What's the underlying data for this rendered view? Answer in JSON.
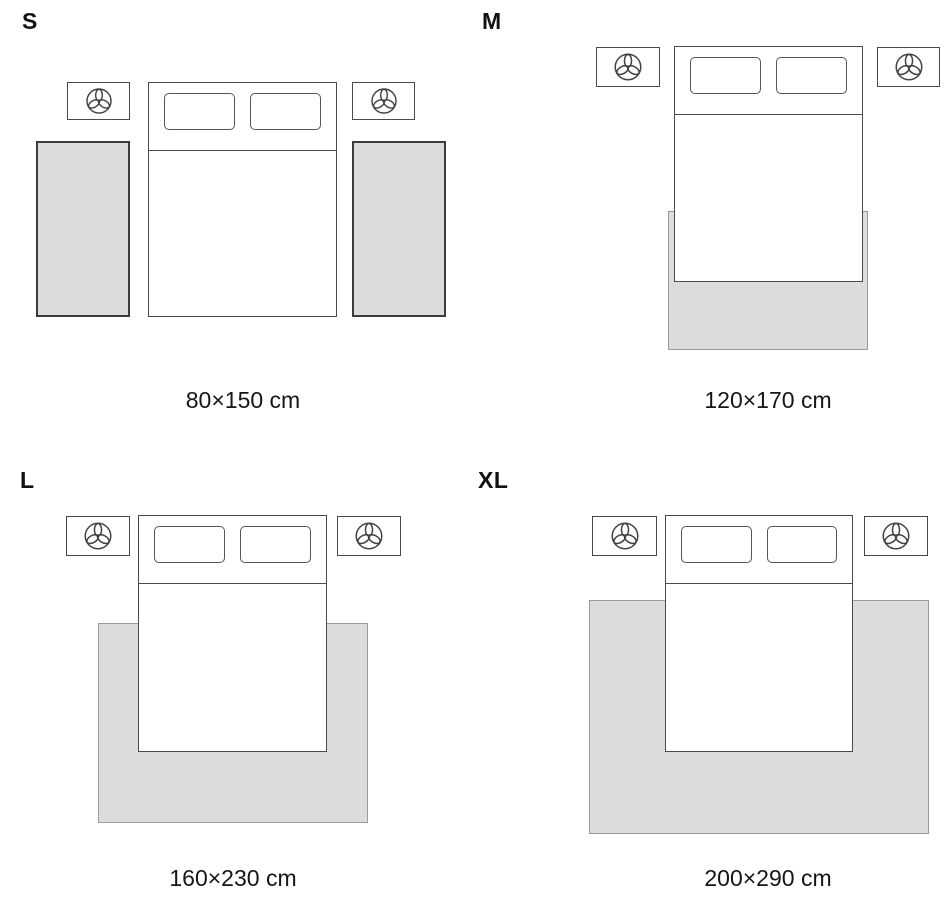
{
  "colors": {
    "background": "#ffffff",
    "rug_fill": "#dcdcdc",
    "rug_border": "#9b9b9b",
    "runner_rug_border": "#3c3c3c",
    "furniture_outline": "#4a4a4a",
    "text": "#111111"
  },
  "icons": {
    "nightstand": "three-petal-plant-icon"
  },
  "panels": [
    {
      "size_label": "S",
      "dimensions": "80×150 cm"
    },
    {
      "size_label": "M",
      "dimensions": "120×170 cm"
    },
    {
      "size_label": "L",
      "dimensions": "160×230 cm"
    },
    {
      "size_label": "XL",
      "dimensions": "200×290 cm"
    }
  ]
}
